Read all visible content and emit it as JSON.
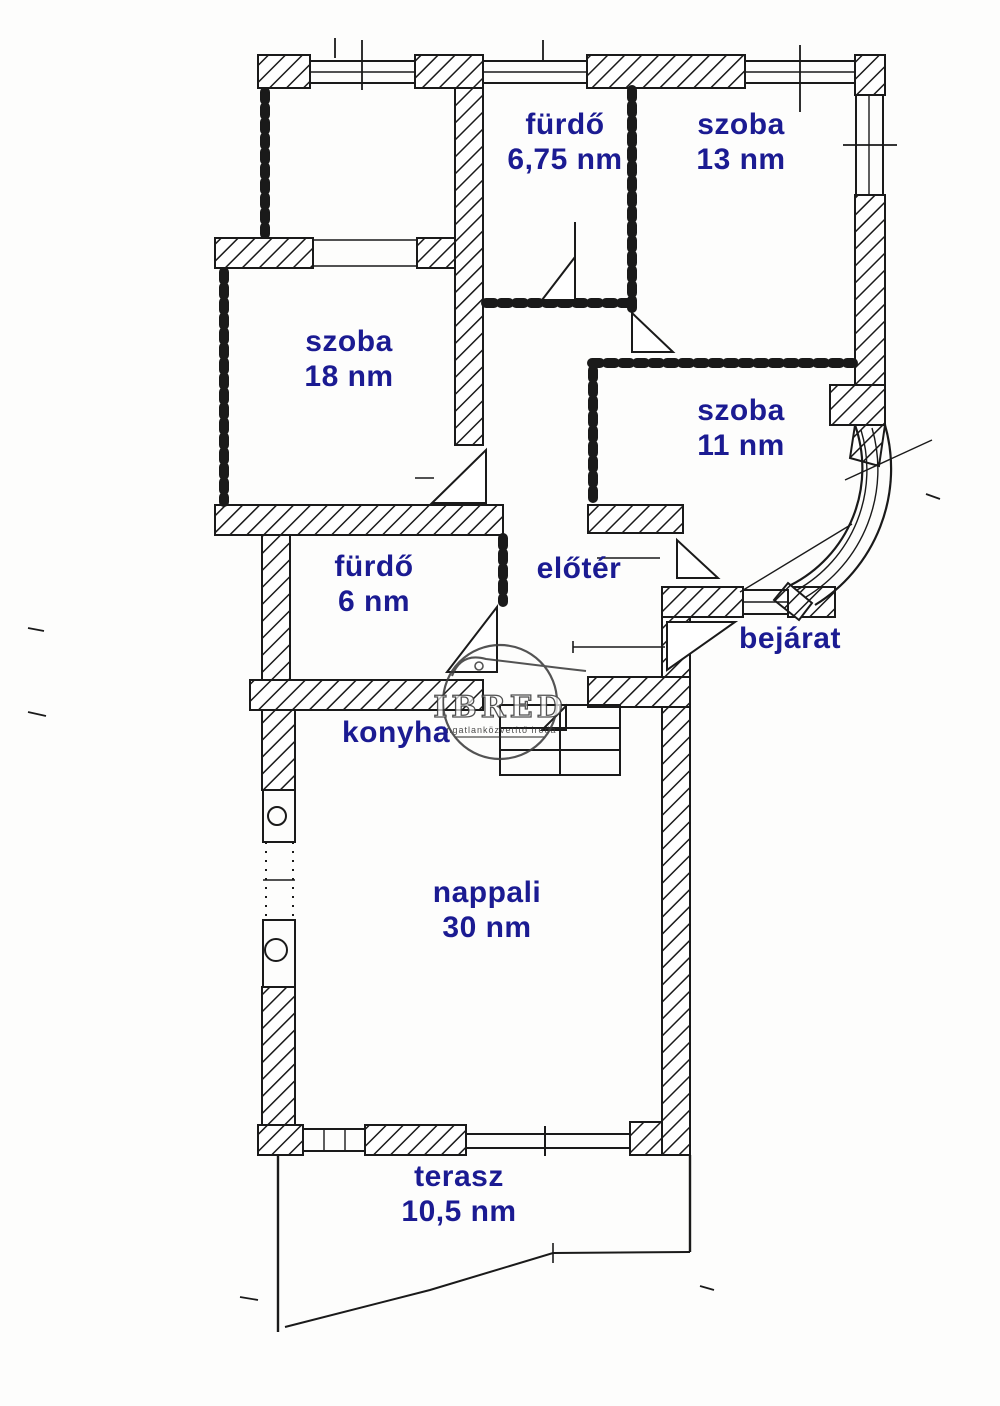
{
  "plan": {
    "type": "floor-plan",
    "language": "hu",
    "area_unit": "nm",
    "rooms": [
      {
        "id": "furdo-675",
        "name": "fürdő",
        "area": "6,75 nm"
      },
      {
        "id": "szoba-13",
        "name": "szoba",
        "area": "13 nm"
      },
      {
        "id": "szoba-18",
        "name": "szoba",
        "area": "18 nm"
      },
      {
        "id": "szoba-11",
        "name": "szoba",
        "area": "11 nm"
      },
      {
        "id": "furdo-6",
        "name": "fürdő",
        "area": "6 nm"
      },
      {
        "id": "eloter",
        "name": "előtér",
        "area": ""
      },
      {
        "id": "bejarat",
        "name": "bejárat",
        "area": ""
      },
      {
        "id": "konyha",
        "name": "konyha",
        "area": ""
      },
      {
        "id": "nappali",
        "name": "nappali",
        "area": "30 nm"
      },
      {
        "id": "terasz",
        "name": "terasz",
        "area": "10,5 nm"
      }
    ],
    "watermark": {
      "brand": "IBRED",
      "subtext": "ingatlanközvetítő iroda"
    },
    "colors": {
      "label": "#1b1b92",
      "line": "#1a1a1a",
      "background": "#fdfdfc"
    }
  }
}
